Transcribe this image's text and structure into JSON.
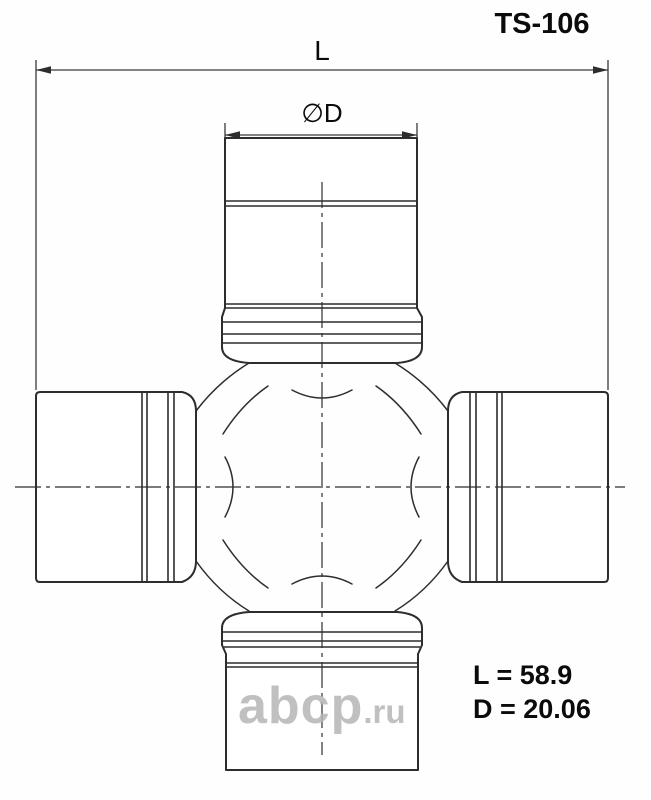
{
  "part_number": "TS-106",
  "dimensions": {
    "length_label": "L",
    "diameter_label": "∅D"
  },
  "specs": {
    "length_text": "L = 58.9",
    "diameter_text": "D = 20.06"
  },
  "watermark": {
    "brand": "abcp",
    "tld": ".ru"
  },
  "colors": {
    "line": "#2d2d2d",
    "text": "#0b0b0b",
    "watermark": "#b6b6b6",
    "background": "#ffffff"
  }
}
